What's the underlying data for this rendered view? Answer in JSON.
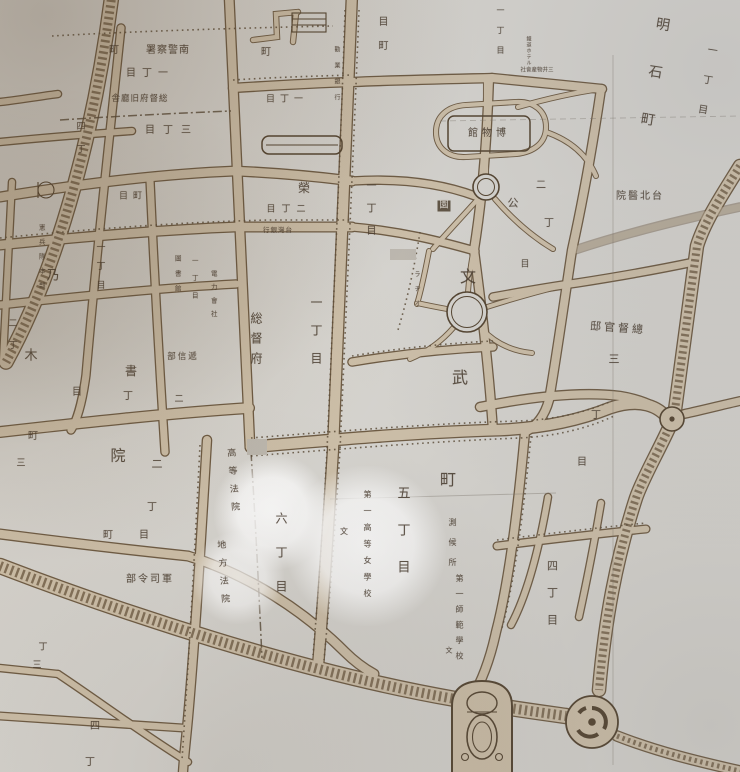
{
  "map": {
    "colors": {
      "paper": "#d8d6d1",
      "road": "#cfc1aa",
      "casing": "#6e5b43",
      "ink": "#46392c",
      "glow": "#ffffff"
    },
    "labels": [
      {
        "id": "minami-keisatsusho",
        "text": "署察警南",
        "o": "h",
        "x": 168,
        "y": 51,
        "s": 10,
        "sp": 1
      },
      {
        "id": "cho-a",
        "text": "町",
        "o": "h",
        "x": 114,
        "y": 51,
        "s": 10
      },
      {
        "id": "itchome-a",
        "text": "目丁一",
        "o": "h",
        "x": 150,
        "y": 74,
        "s": 10,
        "sp": 6
      },
      {
        "id": "sotokufu-kyuchosha",
        "text": "舎廳旧府督総",
        "o": "h",
        "x": 140,
        "y": 99,
        "s": 8.5,
        "sp": 1
      },
      {
        "id": "sanchome-a",
        "text": "目丁三",
        "o": "h",
        "x": 172,
        "y": 131,
        "s": 10,
        "sp": 8
      },
      {
        "id": "yonchome-a",
        "text": "四丁",
        "o": "v",
        "x": 79,
        "y": 121,
        "s": 9,
        "sp": 14
      },
      {
        "id": "chome-b",
        "text": "目町",
        "o": "h",
        "x": 133,
        "y": 197,
        "s": 9,
        "sp": 5
      },
      {
        "id": "nogi-no",
        "text": "乃",
        "o": "h",
        "x": 53,
        "y": 276,
        "s": 13
      },
      {
        "id": "nogi-ki",
        "text": "木",
        "o": "h",
        "x": 31,
        "y": 356,
        "s": 13
      },
      {
        "id": "kenpeitai-honbu",
        "text": "憲兵隊本部",
        "o": "v",
        "x": 41,
        "y": 224,
        "s": 6.5,
        "sp": 8
      },
      {
        "id": "itchome-b",
        "text": "一丁目",
        "o": "v",
        "x": 99,
        "y": 242,
        "s": 9,
        "sp": 10
      },
      {
        "id": "nichome-a",
        "text": "二丁",
        "o": "v",
        "x": 11,
        "y": 318,
        "s": 9,
        "sp": 13
      },
      {
        "id": "cho-c",
        "text": "町",
        "o": "h",
        "x": 33,
        "y": 437,
        "s": 10
      },
      {
        "id": "san-a",
        "text": "三",
        "o": "h",
        "x": 21,
        "y": 464,
        "s": 9
      },
      {
        "id": "denryoku-gaisha",
        "text": "電力會社",
        "o": "v",
        "x": 213,
        "y": 270,
        "s": 6.5,
        "sp": 7
      },
      {
        "id": "itchome-c",
        "text": "一丁目",
        "o": "v",
        "x": 194,
        "y": 257,
        "s": 6.5,
        "sp": 11
      },
      {
        "id": "toshokan",
        "text": "圖書館",
        "o": "v",
        "x": 177,
        "y": 255,
        "s": 6.5,
        "sp": 8.5
      },
      {
        "id": "teishinbu",
        "text": "部信遞",
        "o": "h",
        "x": 183,
        "y": 357,
        "s": 8.5,
        "sp": 2
      },
      {
        "id": "ni-b",
        "text": "二",
        "o": "h",
        "x": 179,
        "y": 400,
        "s": 9
      },
      {
        "id": "sho",
        "text": "書",
        "o": "h",
        "x": 131,
        "y": 371,
        "s": 12
      },
      {
        "id": "cho-d",
        "text": "丁",
        "o": "h",
        "x": 128,
        "y": 397,
        "s": 10
      },
      {
        "id": "me-a",
        "text": "目",
        "o": "h",
        "x": 77,
        "y": 393,
        "s": 10
      },
      {
        "id": "in-big",
        "text": "院",
        "o": "h",
        "x": 118,
        "y": 456,
        "s": 15
      },
      {
        "id": "ni-c",
        "text": "二",
        "o": "h",
        "x": 157,
        "y": 464,
        "s": 11
      },
      {
        "id": "sotokufu",
        "text": "総督府",
        "o": "v",
        "x": 256,
        "y": 312,
        "s": 12,
        "sp": 8
      },
      {
        "id": "itchome-d",
        "text": "一丁目",
        "o": "v",
        "x": 316,
        "y": 296,
        "s": 12,
        "sp": 16
      },
      {
        "id": "bun",
        "text": "文",
        "o": "h",
        "x": 468,
        "y": 277,
        "s": 16
      },
      {
        "id": "bu",
        "text": "武",
        "o": "h",
        "x": 460,
        "y": 378,
        "s": 16
      },
      {
        "id": "machi",
        "text": "町",
        "o": "h",
        "x": 448,
        "y": 480,
        "s": 16
      },
      {
        "id": "gochome",
        "text": "五丁目",
        "o": "v",
        "x": 402,
        "y": 486,
        "s": 13,
        "sp": 24
      },
      {
        "id": "rokuchome",
        "text": "六丁目",
        "o": "v",
        "x": 281,
        "y": 512,
        "s": 12,
        "sp": 22
      },
      {
        "id": "koto-hoin",
        "text": "高等法院",
        "o": "v",
        "x": 232,
        "y": 448,
        "s": 9,
        "sp": 9,
        "rot": -4
      },
      {
        "id": "chiho-hoin",
        "text": "地方法院",
        "o": "v",
        "x": 222,
        "y": 540,
        "s": 9,
        "sp": 9,
        "rot": -4
      },
      {
        "id": "daiichi-koto-jogakko",
        "text": "第一高等女學校",
        "o": "v",
        "x": 367,
        "y": 490,
        "s": 8,
        "sp": 8.5
      },
      {
        "id": "bun-b",
        "text": "文",
        "o": "h",
        "x": 344,
        "y": 532,
        "s": 8
      },
      {
        "id": "sokkojo",
        "text": "測候所",
        "o": "v",
        "x": 452,
        "y": 518,
        "s": 8,
        "sp": 12
      },
      {
        "id": "daiichi-shihan-gakko",
        "text": "第一師範學校",
        "o": "v",
        "x": 459,
        "y": 574,
        "s": 8,
        "sp": 7.5
      },
      {
        "id": "bun-c",
        "text": "文",
        "o": "h",
        "x": 449,
        "y": 651,
        "s": 7
      },
      {
        "id": "yonchome-b",
        "text": "四丁目",
        "o": "v",
        "x": 552,
        "y": 560,
        "s": 11,
        "sp": 16
      },
      {
        "id": "sotoku-kantei",
        "text": "邸官督總",
        "o": "h",
        "x": 618,
        "y": 328,
        "s": 11,
        "sp": 3,
        "rot": 4
      },
      {
        "id": "san-b",
        "text": "三",
        "o": "h",
        "x": 614,
        "y": 359,
        "s": 11
      },
      {
        "id": "cho-e",
        "text": "丁",
        "o": "h",
        "x": 596,
        "y": 416,
        "s": 10
      },
      {
        "id": "me-b",
        "text": "目",
        "o": "h",
        "x": 582,
        "y": 463,
        "s": 10
      },
      {
        "id": "akashicho",
        "text": "明石町",
        "o": "v",
        "x": 652,
        "y": 16,
        "s": 14,
        "sp": 34,
        "rot": 9
      },
      {
        "id": "itchome-e",
        "text": "一丁目",
        "o": "v",
        "x": 704,
        "y": 44,
        "s": 10,
        "sp": 20,
        "rot": 9
      },
      {
        "id": "taihoku-byoin",
        "text": "院醫北台",
        "o": "h",
        "x": 640,
        "y": 197,
        "s": 10,
        "sp": 2
      },
      {
        "id": "itchome-f",
        "text": "一丁目",
        "o": "v",
        "x": 500,
        "y": 6,
        "s": 8,
        "sp": 12
      },
      {
        "id": "tetsudo-hotel",
        "text": "鐵道ホテル",
        "o": "v",
        "x": 528,
        "y": 36,
        "s": 5,
        "sp": 1
      },
      {
        "id": "mitsui-bussan",
        "text": "社會産物井三",
        "o": "h",
        "x": 537,
        "y": 71,
        "s": 5.5
      },
      {
        "id": "hakubutsukan",
        "text": "館物博",
        "o": "h",
        "x": 489,
        "y": 134,
        "s": 10,
        "sp": 4
      },
      {
        "id": "en-box",
        "text": "園",
        "o": "h",
        "x": 444,
        "y": 206,
        "s": 9,
        "box": true
      },
      {
        "id": "ko",
        "text": "公",
        "o": "h",
        "x": 513,
        "y": 203,
        "s": 11
      },
      {
        "id": "ni-d",
        "text": "二",
        "o": "h",
        "x": 541,
        "y": 186,
        "s": 10
      },
      {
        "id": "cho-f",
        "text": "丁",
        "o": "h",
        "x": 549,
        "y": 224,
        "s": 10
      },
      {
        "id": "rajio",
        "text": "ラヂオ",
        "o": "v",
        "x": 416,
        "y": 271,
        "s": 6,
        "sp": 8.5
      },
      {
        "id": "itchome-g",
        "text": "一丁目",
        "o": "v",
        "x": 369,
        "y": 180,
        "s": 10,
        "sp": 12.5
      },
      {
        "id": "sakae",
        "text": "榮",
        "o": "h",
        "x": 304,
        "y": 188,
        "s": 12
      },
      {
        "id": "nichome-e",
        "text": "目丁二",
        "o": "h",
        "x": 289,
        "y": 210,
        "s": 9,
        "sp": 6
      },
      {
        "id": "taiwan-ginko",
        "text": "行銀灣台",
        "o": "h",
        "x": 278,
        "y": 230,
        "s": 6.5,
        "sp": 1
      },
      {
        "id": "cho-g",
        "text": "町",
        "o": "h",
        "x": 266,
        "y": 53,
        "s": 10
      },
      {
        "id": "itchome-h",
        "text": "目丁一",
        "o": "h",
        "x": 287,
        "y": 100,
        "s": 9,
        "sp": 5
      },
      {
        "id": "kangyo-ginko",
        "text": "勸業銀行",
        "o": "v",
        "x": 336,
        "y": 46,
        "s": 6,
        "sp": 10
      },
      {
        "id": "mecho",
        "text": "目町",
        "o": "v",
        "x": 381,
        "y": 16,
        "s": 10,
        "sp": 14
      },
      {
        "id": "me-c",
        "text": "目",
        "o": "h",
        "x": 525,
        "y": 265,
        "s": 9
      },
      {
        "id": "cho-h",
        "text": "丁",
        "o": "h",
        "x": 152,
        "y": 508,
        "s": 10
      },
      {
        "id": "me-d",
        "text": "目",
        "o": "h",
        "x": 144,
        "y": 536,
        "s": 10
      },
      {
        "id": "cho-i",
        "text": "町",
        "o": "h",
        "x": 108,
        "y": 536,
        "s": 10
      },
      {
        "id": "gunshireibu",
        "text": "部令司軍",
        "o": "h",
        "x": 150,
        "y": 580,
        "s": 10,
        "sp": 2
      },
      {
        "id": "cho-j",
        "text": "丁",
        "o": "h",
        "x": 43,
        "y": 648,
        "s": 9
      },
      {
        "id": "san-c",
        "text": "三",
        "o": "h",
        "x": 37,
        "y": 666,
        "s": 9
      },
      {
        "id": "yon-b",
        "text": "四",
        "o": "h",
        "x": 95,
        "y": 727,
        "s": 10
      },
      {
        "id": "cho-k",
        "text": "丁",
        "o": "h",
        "x": 90,
        "y": 763,
        "s": 10
      }
    ],
    "highlights": [
      {
        "cx": 272,
        "cy": 512,
        "r": 58,
        "opacity": 0.95
      },
      {
        "cx": 238,
        "cy": 578,
        "r": 46,
        "opacity": 0.75
      },
      {
        "cx": 366,
        "cy": 546,
        "r": 80,
        "opacity": 0.95
      }
    ]
  }
}
